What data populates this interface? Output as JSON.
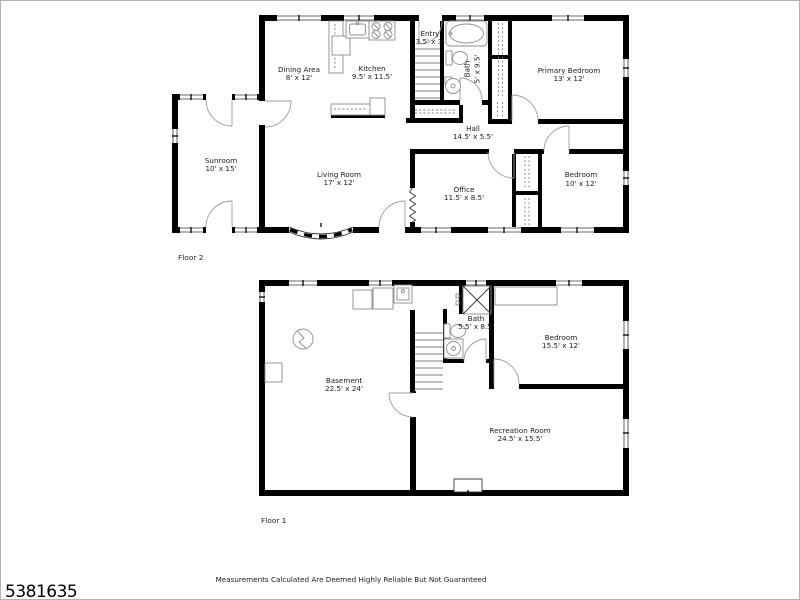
{
  "page": {
    "listing_number": "5381635",
    "disclaimer": "Measurements Calculated Are Deemed Highly Reliable But Not Guaranteed"
  },
  "floor2": {
    "label": "Floor 2",
    "rooms": {
      "dining": {
        "name": "Dining Area",
        "dims": "8' x 12'"
      },
      "kitchen": {
        "name": "Kitchen",
        "dims": "9.5' x 11.5'"
      },
      "entry": {
        "name": "Entry",
        "dims": "3.5' x 3'"
      },
      "bath": {
        "name": "Bath",
        "dims": "5' x 9.5'"
      },
      "primary_bedroom": {
        "name": "Primary Bedroom",
        "dims": "13' x 12'"
      },
      "hall": {
        "name": "Hall",
        "dims": "14.5' x 5.5'"
      },
      "sunroom": {
        "name": "Sunroom",
        "dims": "10' x 15'"
      },
      "living_room": {
        "name": "Living Room",
        "dims": "17' x 12'"
      },
      "office": {
        "name": "Office",
        "dims": "11.5' x 8.5'"
      },
      "bedroom": {
        "name": "Bedroom",
        "dims": "10' x 12'"
      }
    }
  },
  "floor1": {
    "label": "Floor 1",
    "rooms": {
      "basement": {
        "name": "Basement",
        "dims": "22.5' x 24'"
      },
      "bath": {
        "name": "Bath",
        "dims": "5.5' x 8.5'"
      },
      "bedroom": {
        "name": "Bedroom",
        "dims": "15.5' x 12'"
      },
      "recreation_room": {
        "name": "Recreation Room",
        "dims": "24.5' x 15.5'"
      }
    }
  }
}
